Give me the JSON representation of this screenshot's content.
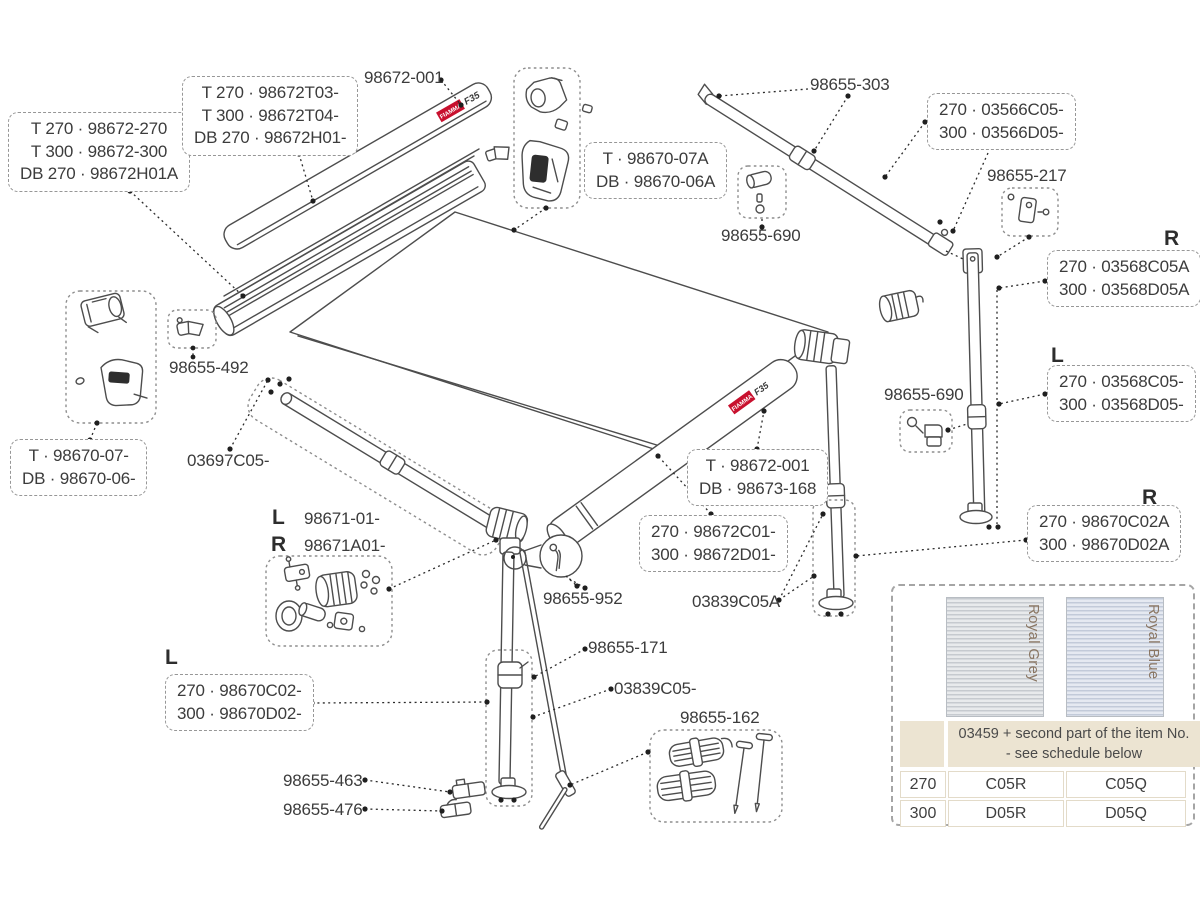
{
  "logo": {
    "brand": "FIAMMA",
    "model": "F35"
  },
  "colors": {
    "accent_red": "#c8102e",
    "table_beige": "#ece4d2",
    "swatch_label": "#8a7663",
    "line": "#4d4d4d"
  },
  "labels": {
    "case_fabric_set": {
      "lines": [
        "T 270 · 98672-270",
        "T 300 · 98672-300",
        "DB 270 · 98672H01A"
      ]
    },
    "case_profile_set": {
      "lines": [
        "T 270 · 98672T03-",
        "T 300 · 98672T04-",
        "DB 270 · 98672H01-"
      ]
    },
    "case_top": "98672-001",
    "end_caps": {
      "lines": [
        "T · 98670-07A",
        "DB · 98670-06A"
      ]
    },
    "knob_top": "98655-690",
    "rafter_arm": "98655-303",
    "rafter_tube_set": {
      "lines": [
        "270 · 03566C05-",
        "300 · 03566D05-"
      ]
    },
    "bracket_217": "98655-217",
    "r_top": "R",
    "leg_tube_right": {
      "lines": [
        "270 · 03568C05A",
        "300 · 03568D05A"
      ]
    },
    "l_mid": "L",
    "leg_tube_left": {
      "lines": [
        "270 · 03568C05-",
        "300 · 03568D05-"
      ]
    },
    "clamp_492": "98655-492",
    "knob_right": "98655-690",
    "end_caps_lower": {
      "lines": [
        "T · 98670-07-",
        "DB · 98670-06-"
      ]
    },
    "arm_tube": "03697C05-",
    "l_arm": "L",
    "knuckle_left_no": "98671-01-",
    "r_arm": "R",
    "knuckle_right_no": "98671A01-",
    "lead_rail_set": {
      "lines": [
        "T · 98672-001",
        "DB · 98673-168"
      ]
    },
    "lead_bar_set": {
      "lines": [
        "270 · 98672C01-",
        "300 · 98672D01-"
      ]
    },
    "pin_952": "98655-952",
    "spigot_a": "03839C05A",
    "r_leg": "R",
    "leg_right_set": {
      "lines": [
        "270 · 98670C02A",
        "300 · 98670D02A"
      ]
    },
    "l_leg": "L",
    "leg_left_set": {
      "lines": [
        "270 · 98670C02-",
        "300 · 98670D02-"
      ]
    },
    "clamp_171": "98655-171",
    "spigot": "03839C05-",
    "tie_down_kit": "98655-162",
    "foot_463": "98655-463",
    "foot_476": "98655-476"
  },
  "fabric_table": {
    "swatches": [
      {
        "name": "Royal Grey"
      },
      {
        "name": "Royal Blue"
      }
    ],
    "header": "03459 + second part of the item No. - see schedule below",
    "rows": [
      {
        "size": "270",
        "grey": "C05R",
        "blue": "C05Q"
      },
      {
        "size": "300",
        "grey": "D05R",
        "blue": "D05Q"
      }
    ]
  }
}
